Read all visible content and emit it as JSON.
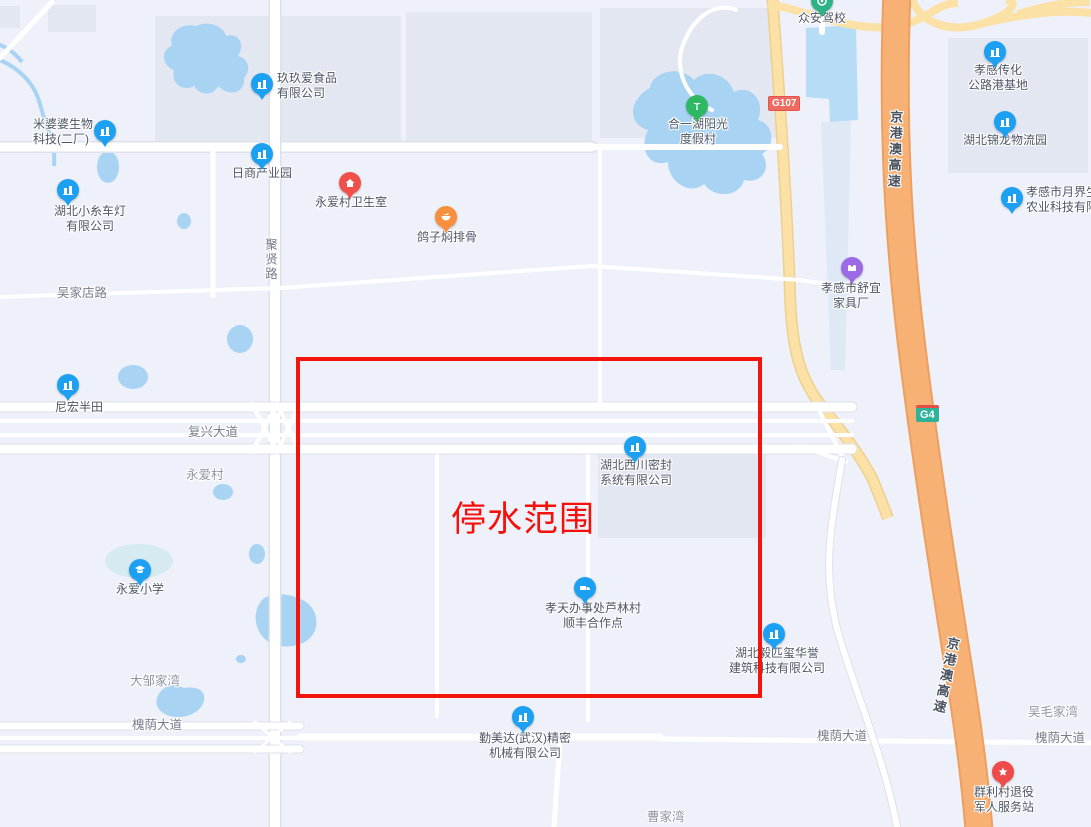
{
  "overlay": {
    "zone_label": "停水范围"
  },
  "badges": {
    "g107": "G107",
    "g4": "G4"
  },
  "highways": {
    "jinggangao": "京港澳高速"
  },
  "roads": {
    "juxian": "聚贤路",
    "wujiadian": "吴家店路",
    "fuxing": "复兴大道",
    "huaiyin": "槐荫大道"
  },
  "villages": {
    "yongai": "永爱村",
    "dazoujiawan": "大邹家湾",
    "wumaojiawan": "吴毛家湾",
    "caojiawan": "曹家湾"
  },
  "pois": {
    "jiujiuai": {
      "lines": [
        "玖玖爱食品",
        "有限公司"
      ]
    },
    "mipopo": {
      "lines": [
        "米婆婆生物",
        "科技(二厂)"
      ]
    },
    "koito": {
      "lines": [
        "湖北小糸车灯",
        "有限公司"
      ]
    },
    "rishang": {
      "lines": [
        "日商产业园"
      ]
    },
    "clinic": {
      "lines": [
        "永爱村卫生室"
      ]
    },
    "pigeon": {
      "lines": [
        "鸽子焖排骨"
      ]
    },
    "nihong": {
      "lines": [
        "尼宏半田"
      ]
    },
    "xichuan": {
      "lines": [
        "湖北西川密封",
        "系统有限公司"
      ]
    },
    "sfpoint": {
      "lines": [
        "孝天办事处芦林村",
        "顺丰合作点"
      ]
    },
    "yipixi": {
      "lines": [
        "湖北毅匹玺华誉",
        "建筑科技有限公司"
      ]
    },
    "qinmeida": {
      "lines": [
        "勤美达(武汉)精密",
        "机械有限公司"
      ]
    },
    "primary": {
      "lines": [
        "永爱小学"
      ]
    },
    "chuanhua": {
      "lines": [
        "孝感传化",
        "公路港基地"
      ]
    },
    "jinlong": {
      "lines": [
        "湖北锦龙物流园"
      ]
    },
    "yuejie": {
      "lines": [
        "孝感市月界生",
        "农业科技有限公"
      ]
    },
    "zhongan": {
      "lines": [
        "众安驾校"
      ]
    },
    "heyihu": {
      "lines": [
        "合一湖阳光",
        "度假村"
      ]
    },
    "shuyi": {
      "lines": [
        "孝感市舒宜",
        "家具厂"
      ]
    },
    "qunli": {
      "lines": [
        "群利村退役",
        "军人服务站"
      ]
    }
  },
  "colors": {
    "zone_red": "#f3140e",
    "expressway_orange": "#f8b175",
    "national_road_yellow": "#fbe1a6",
    "water_blue": "#a9d3f3",
    "pin_blue": "#1ca1f2",
    "pin_red": "#f0504a",
    "pin_orange": "#f78f3d",
    "pin_green": "#2eb864",
    "pin_purple": "#9b6ae4",
    "g107_badge": "#ef6a60",
    "g4_badge": "#2eb39b"
  }
}
